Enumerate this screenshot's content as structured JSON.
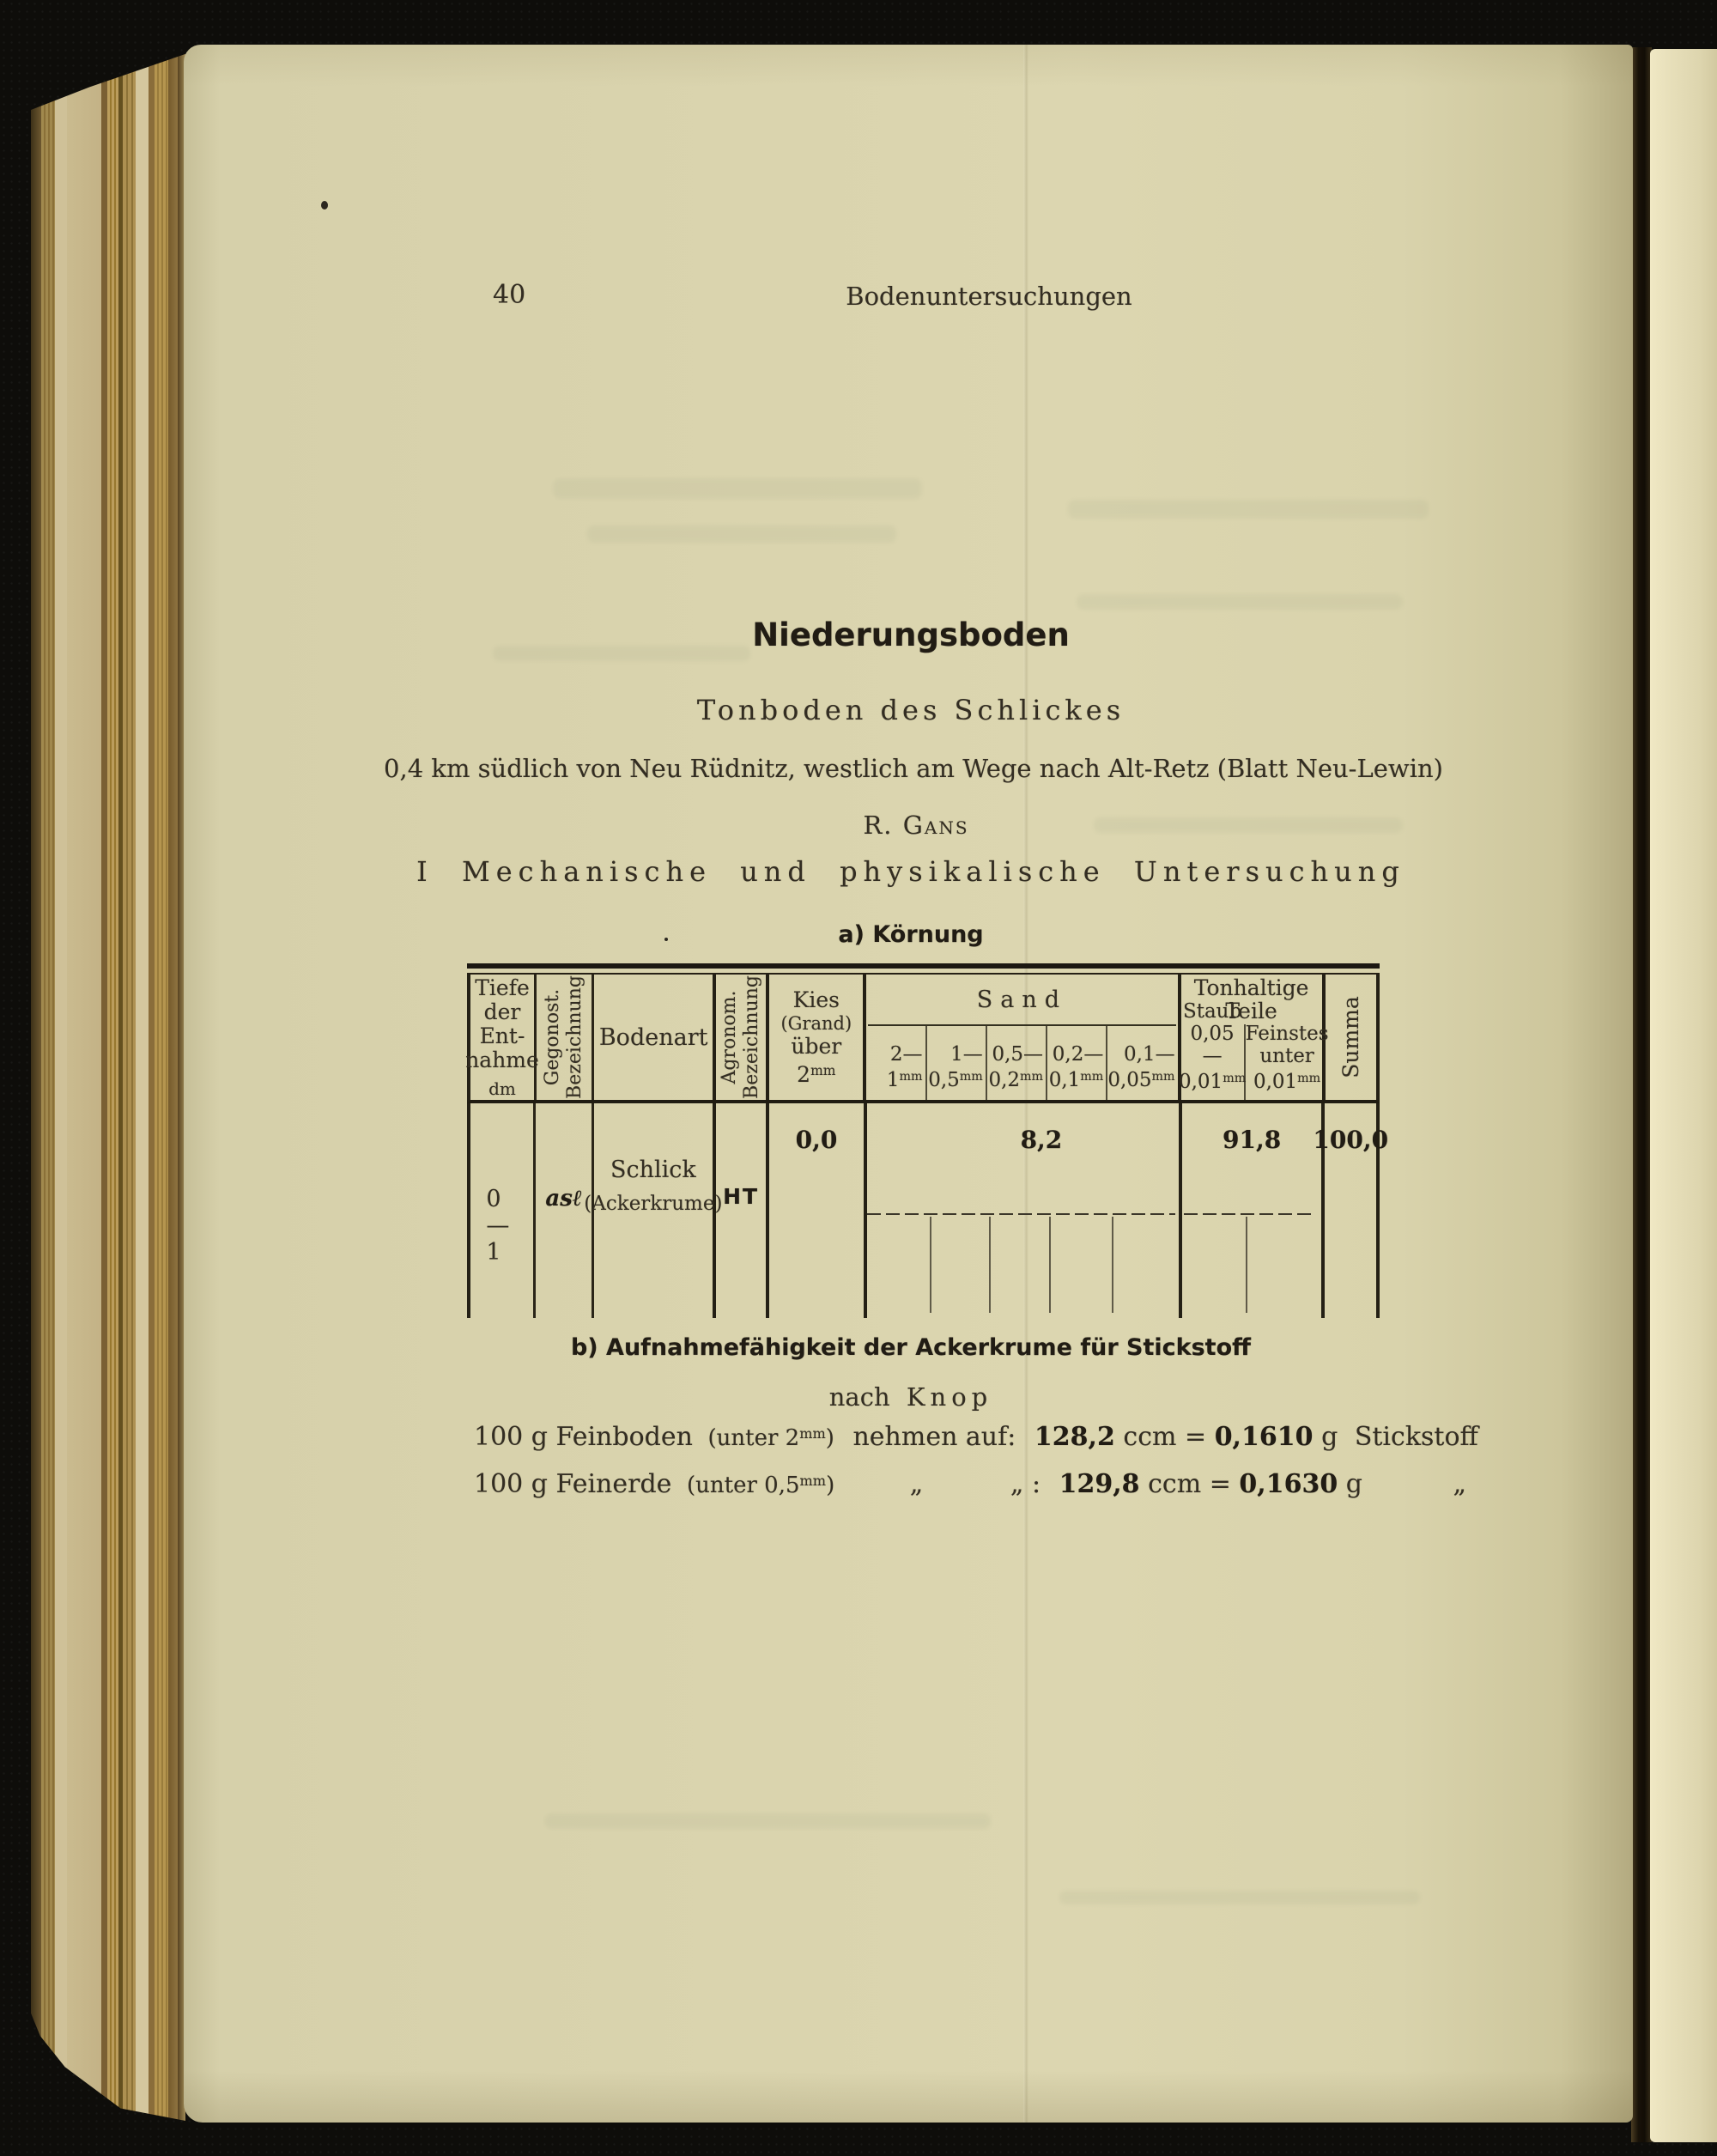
{
  "palette": {
    "paper": "#dad4ae",
    "paper_right": "#e7dfba",
    "ink": "#332d22",
    "ink_bold": "#211c14",
    "background": "#0e0d0a"
  },
  "running_header": {
    "page_number": "40",
    "title": "Bodenuntersuchungen"
  },
  "headings": {
    "main": "Niederungsboden",
    "sub": "Tonboden des Schlickes",
    "location": "0,4 km südlich von Neu Rüdnitz, westlich am Wege nach Alt-Retz (Blatt Neu-Lewin)",
    "author": "R. Gans",
    "part": "I Mechanische und physikalische Untersuchung",
    "table_caption": "a) Körnung"
  },
  "table": {
    "col_tiefe": {
      "l1": "Tiefe",
      "l2": "der",
      "l3": "Ent-",
      "l4": "nahme",
      "unit": "dm"
    },
    "col_geognost": {
      "l1": "Gegonost.",
      "l2": "Bezeichnung"
    },
    "col_bodenart": "Bodenart",
    "col_agronom": {
      "l1": "Agronom.",
      "l2": "Bezeichnung"
    },
    "col_kies": {
      "l1": "Kies",
      "l2": "(Grand)",
      "l3": "über",
      "num": "2",
      "unit": "mm"
    },
    "sand": {
      "label": "Sand",
      "cols": [
        {
          "from": "2—",
          "to": "1",
          "unit": "mm"
        },
        {
          "from": "1—",
          "to": "0,5",
          "unit": "mm"
        },
        {
          "from": "0,5—",
          "to": "0,2",
          "unit": "mm"
        },
        {
          "from": "0,2—",
          "to": "0,1",
          "unit": "mm"
        },
        {
          "from": "0,1—",
          "to": "0,05",
          "unit": "mm"
        }
      ]
    },
    "ton": {
      "l1": "Tonhaltige",
      "l2": "Teile",
      "staub": {
        "l1": "Staub",
        "l2": "0,05—",
        "num": "0,01",
        "unit": "mm"
      },
      "feinstes": {
        "l1": "Feinstes",
        "l2": "unter",
        "num": "0,01",
        "unit": "mm"
      }
    },
    "col_summa": "Summa",
    "row": {
      "tiefe": "0—1",
      "geognost": "asℓ",
      "bodenart1": "Schlick",
      "bodenart2": "(Ackerkrume)",
      "agronom": "HT",
      "kies": "0,0",
      "sand": "8,2",
      "ton": "91,8",
      "summa": "100,0"
    }
  },
  "section_b": {
    "caption": "b) Aufnahmefähigkeit der Ackerkrume für Stickstoff",
    "method_pre": "nach",
    "method_name": "Knop",
    "line1": {
      "lead": "100 g Feinboden",
      "paren_pre": "(unter",
      "paren_num": "2",
      "paren_unit": "mm",
      "paren_post": ")",
      "mid": "nehmen auf:",
      "v1": "128,2",
      "u1": "ccm",
      "eq": "=",
      "v2": "0,1610",
      "u2": "g",
      "tail": "Stickstoff"
    },
    "line2": {
      "lead": "100 g Feinerde",
      "paren_pre": "(unter",
      "paren_num": "0,5",
      "paren_unit": "mm",
      "paren_post": ")",
      "ditto1": "„",
      "ditto2": "„ :",
      "v1": "129,8",
      "u1": "ccm",
      "eq": "=",
      "v2": "0,1630",
      "u2": "g",
      "tail": "„"
    }
  }
}
